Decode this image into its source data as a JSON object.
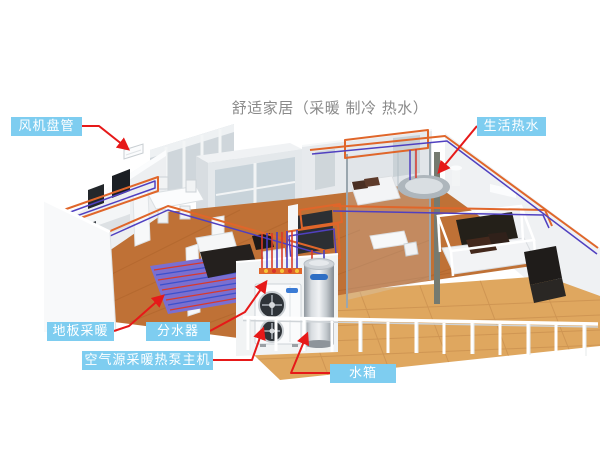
{
  "title": "舒适家居（采暖 制冷 热水）",
  "labels": {
    "fan_coil": "风机盘管",
    "hot_water": "生活热水",
    "floor_heating": "地板采暖",
    "manifold": "分水器",
    "heat_pump": "空气源采暖热泵主机",
    "water_tank": "水箱"
  },
  "colors": {
    "label_bg": "#7ecdf0",
    "leader_line": "#e61919",
    "title_text": "#8a8a8a",
    "pipe_hot": "#e0662a",
    "pipe_cold": "#5040c0"
  }
}
